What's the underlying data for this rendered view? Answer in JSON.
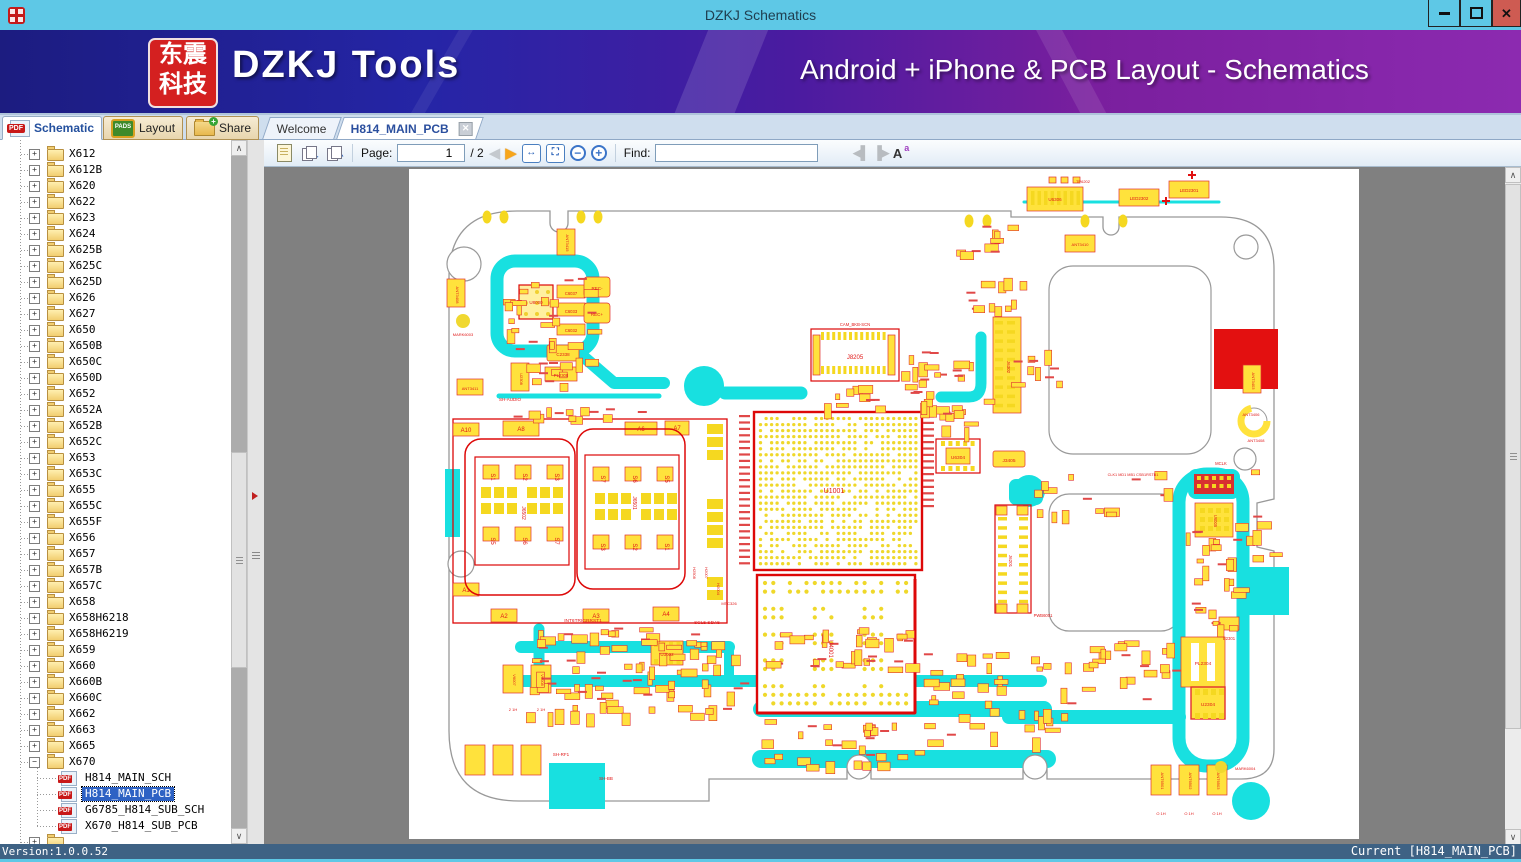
{
  "window": {
    "title": "DZKJ Schematics"
  },
  "banner": {
    "logo_line1": "东震",
    "logo_line2": "科技",
    "title": "DZKJ Tools",
    "subtitle": "Android + iPhone & PCB Layout - Schematics"
  },
  "tabs": {
    "tool_tabs": [
      {
        "label": "Schematic"
      },
      {
        "label": "Layout"
      },
      {
        "label": "Share"
      }
    ],
    "doc_tabs": [
      {
        "label": "Welcome"
      },
      {
        "label": "H814_MAIN_PCB"
      }
    ]
  },
  "toolbar": {
    "page_label": "Page:",
    "page_value": "1",
    "page_total": "/ 2",
    "find_label": "Find:",
    "find_value": ""
  },
  "sidebar": {
    "folders": [
      "X612",
      "X612B",
      "X620",
      "X622",
      "X623",
      "X624",
      "X625B",
      "X625C",
      "X625D",
      "X626",
      "X627",
      "X650",
      "X650B",
      "X650C",
      "X650D",
      "X652",
      "X652A",
      "X652B",
      "X652C",
      "X653",
      "X653C",
      "X655",
      "X655C",
      "X655F",
      "X656",
      "X657",
      "X657B",
      "X657C",
      "X658",
      "X658H6218",
      "X658H6219",
      "X659",
      "X660",
      "X660B",
      "X660C",
      "X662",
      "X663",
      "X665"
    ],
    "expanded": {
      "label": "X670",
      "files": [
        {
          "label": "H814_MAIN_SCH",
          "selected": false
        },
        {
          "label": "H814_MAIN_PCB",
          "selected": true
        },
        {
          "label": "G6785_H814_SUB_SCH",
          "selected": false
        },
        {
          "label": "X670_H814_SUB_PCB",
          "selected": false
        }
      ]
    }
  },
  "statusbar": {
    "version": "Version:1.0.0.52",
    "current": "Current [H814_MAIN_PCB]"
  },
  "pcb": {
    "refs": {
      "u1001": "U1001",
      "u4001": "U4001",
      "j8205": "J8205",
      "cam": "CAM_BKB-SCN",
      "j6302": "J6302",
      "j6201": "J6201",
      "u6304": "U6304",
      "j3405": "J3405",
      "u6005": "U6005",
      "pl2304": "PL2304",
      "u2304": "U2304",
      "b2301": "B2301",
      "u8000": "U8000",
      "c6037": "C6037",
      "c6033": "C6033",
      "c6032": "C6032",
      "c2338": "C2338",
      "pl2308": "PL2308",
      "u2308": "U2308",
      "recm": "REC-",
      "recp": "REC+",
      "ant3408": "ANT3408",
      "ant3411": "ANT3411",
      "ant3415": "ANT3415",
      "mark6003": "MARK6003",
      "sh_audio": "SH-AUDIO",
      "u6306": "U6306",
      "tp6202": "TP6202",
      "led2302": "LED2302",
      "led2301": "LED2301",
      "ant3410": "ANT3410",
      "ant3403": "ANT3403",
      "ant3406": "ANT3406",
      "mclk": "MCLK",
      "pwb6001": "PWB6001",
      "mark6004": "MARK6004",
      "sh_rf1": "SH-RF1",
      "sh_bb": "SH-BB",
      "u3002": "U3002",
      "int6": "INT6TRIGRRST1",
      "scl5": "SCL5 SDA5",
      "clk1": "CLK1 MD1 MB1 CSB1RSTB1",
      "v6007": "V6007",
      "v6008": "V6008",
      "h21": "2 1H",
      "ant6501": "ANT6501",
      "ant6502": "ANT6502",
      "ant6503": "ANT6503",
      "o1h": "O 1H",
      "h2508": "H2508",
      "h2007": "H2007",
      "h2004": "H2004",
      "mtc326": "MTC326"
    },
    "sim": {
      "left_ref": "J6502",
      "right_ref": "J6501",
      "left_top": [
        "S1",
        "S2",
        "S3"
      ],
      "left_bottom": [
        "S5",
        "S6",
        "S7"
      ],
      "right_top": [
        "S7",
        "S6",
        "S5"
      ],
      "right_bottom": [
        "S3",
        "S2",
        "S1"
      ],
      "edge": [
        "A10",
        "A8",
        "A6",
        "A7",
        "A1",
        "A2",
        "A3",
        "A4"
      ]
    },
    "colors": {
      "trace": "#18E0E0",
      "component": "#FFE23C",
      "silk": "#E01818",
      "block": "#E31010"
    }
  }
}
